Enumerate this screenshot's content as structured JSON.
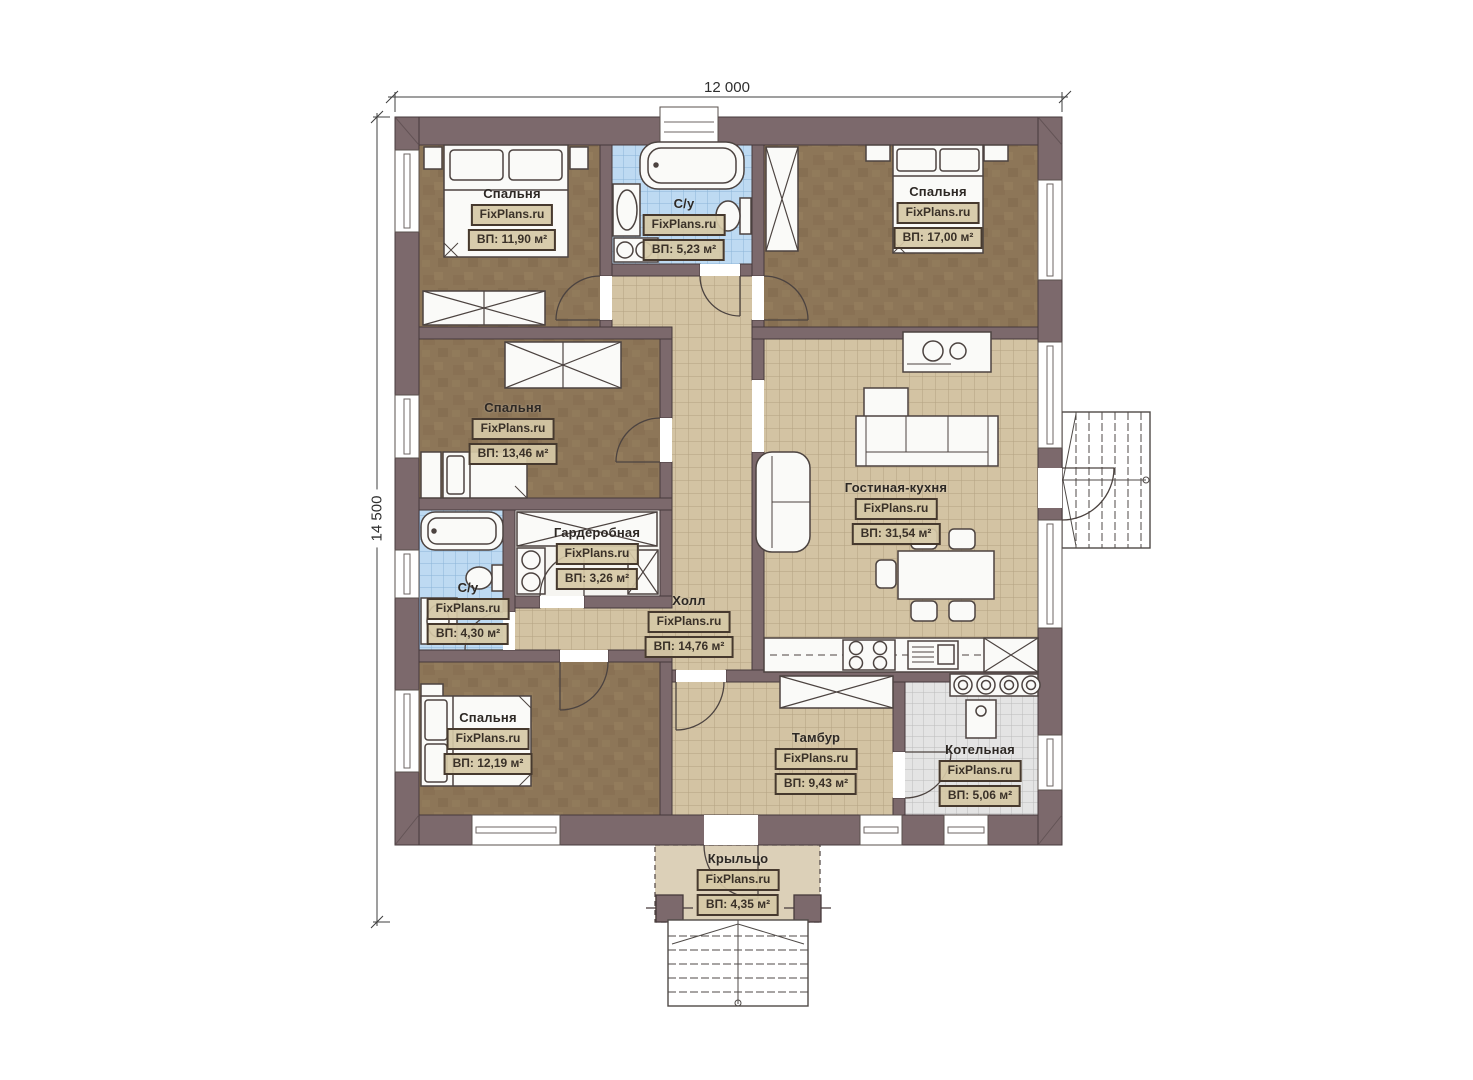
{
  "title": "Floor plan — single storey house",
  "branding": "FixPlans.ru",
  "dimensions": {
    "top": "12 000",
    "left": "14 500"
  },
  "rooms": [
    {
      "id": "bedroom-top-left",
      "name": "Спальня",
      "brand": "FixPlans.ru",
      "area": "ВП: 11,90 м²"
    },
    {
      "id": "bathroom-top",
      "name": "С/у",
      "brand": "FixPlans.ru",
      "area": "ВП: 5,23 м²"
    },
    {
      "id": "bedroom-top-right",
      "name": "Спальня",
      "brand": "FixPlans.ru",
      "area": "ВП: 17,00 м²"
    },
    {
      "id": "bedroom-middle-left",
      "name": "Спальня",
      "brand": "FixPlans.ru",
      "area": "ВП: 13,46 м²"
    },
    {
      "id": "wardrobe",
      "name": "Гардеробная",
      "brand": "FixPlans.ru",
      "area": "ВП: 3,26 м²"
    },
    {
      "id": "bathroom-left",
      "name": "С/у",
      "brand": "FixPlans.ru",
      "area": "ВП: 4,30 м²"
    },
    {
      "id": "living-kitchen",
      "name": "Гостиная-кухня",
      "brand": "FixPlans.ru",
      "area": "ВП: 31,54 м²"
    },
    {
      "id": "hall",
      "name": "Холл",
      "brand": "FixPlans.ru",
      "area": "ВП: 14,76 м²"
    },
    {
      "id": "bedroom-bottom-left",
      "name": "Спальня",
      "brand": "FixPlans.ru",
      "area": "ВП: 12,19 м²"
    },
    {
      "id": "tambour",
      "name": "Тамбур",
      "brand": "FixPlans.ru",
      "area": "ВП: 9,43 м²"
    },
    {
      "id": "boiler-room",
      "name": "Котельная",
      "brand": "FixPlans.ru",
      "area": "ВП: 5,06 м²"
    },
    {
      "id": "porch",
      "name": "Крыльцо",
      "brand": "FixPlans.ru",
      "area": "ВП: 4,35 м²"
    }
  ],
  "colors": {
    "wall": "#7c696c",
    "bedroom_floor": "#8d7658",
    "tile_floor": "#d3c3a3",
    "bath_tile": "#bedaf2",
    "boiler_tile": "#e4e4e4",
    "porch_floor": "#dcd0b8",
    "line": "#4a3f3c"
  }
}
